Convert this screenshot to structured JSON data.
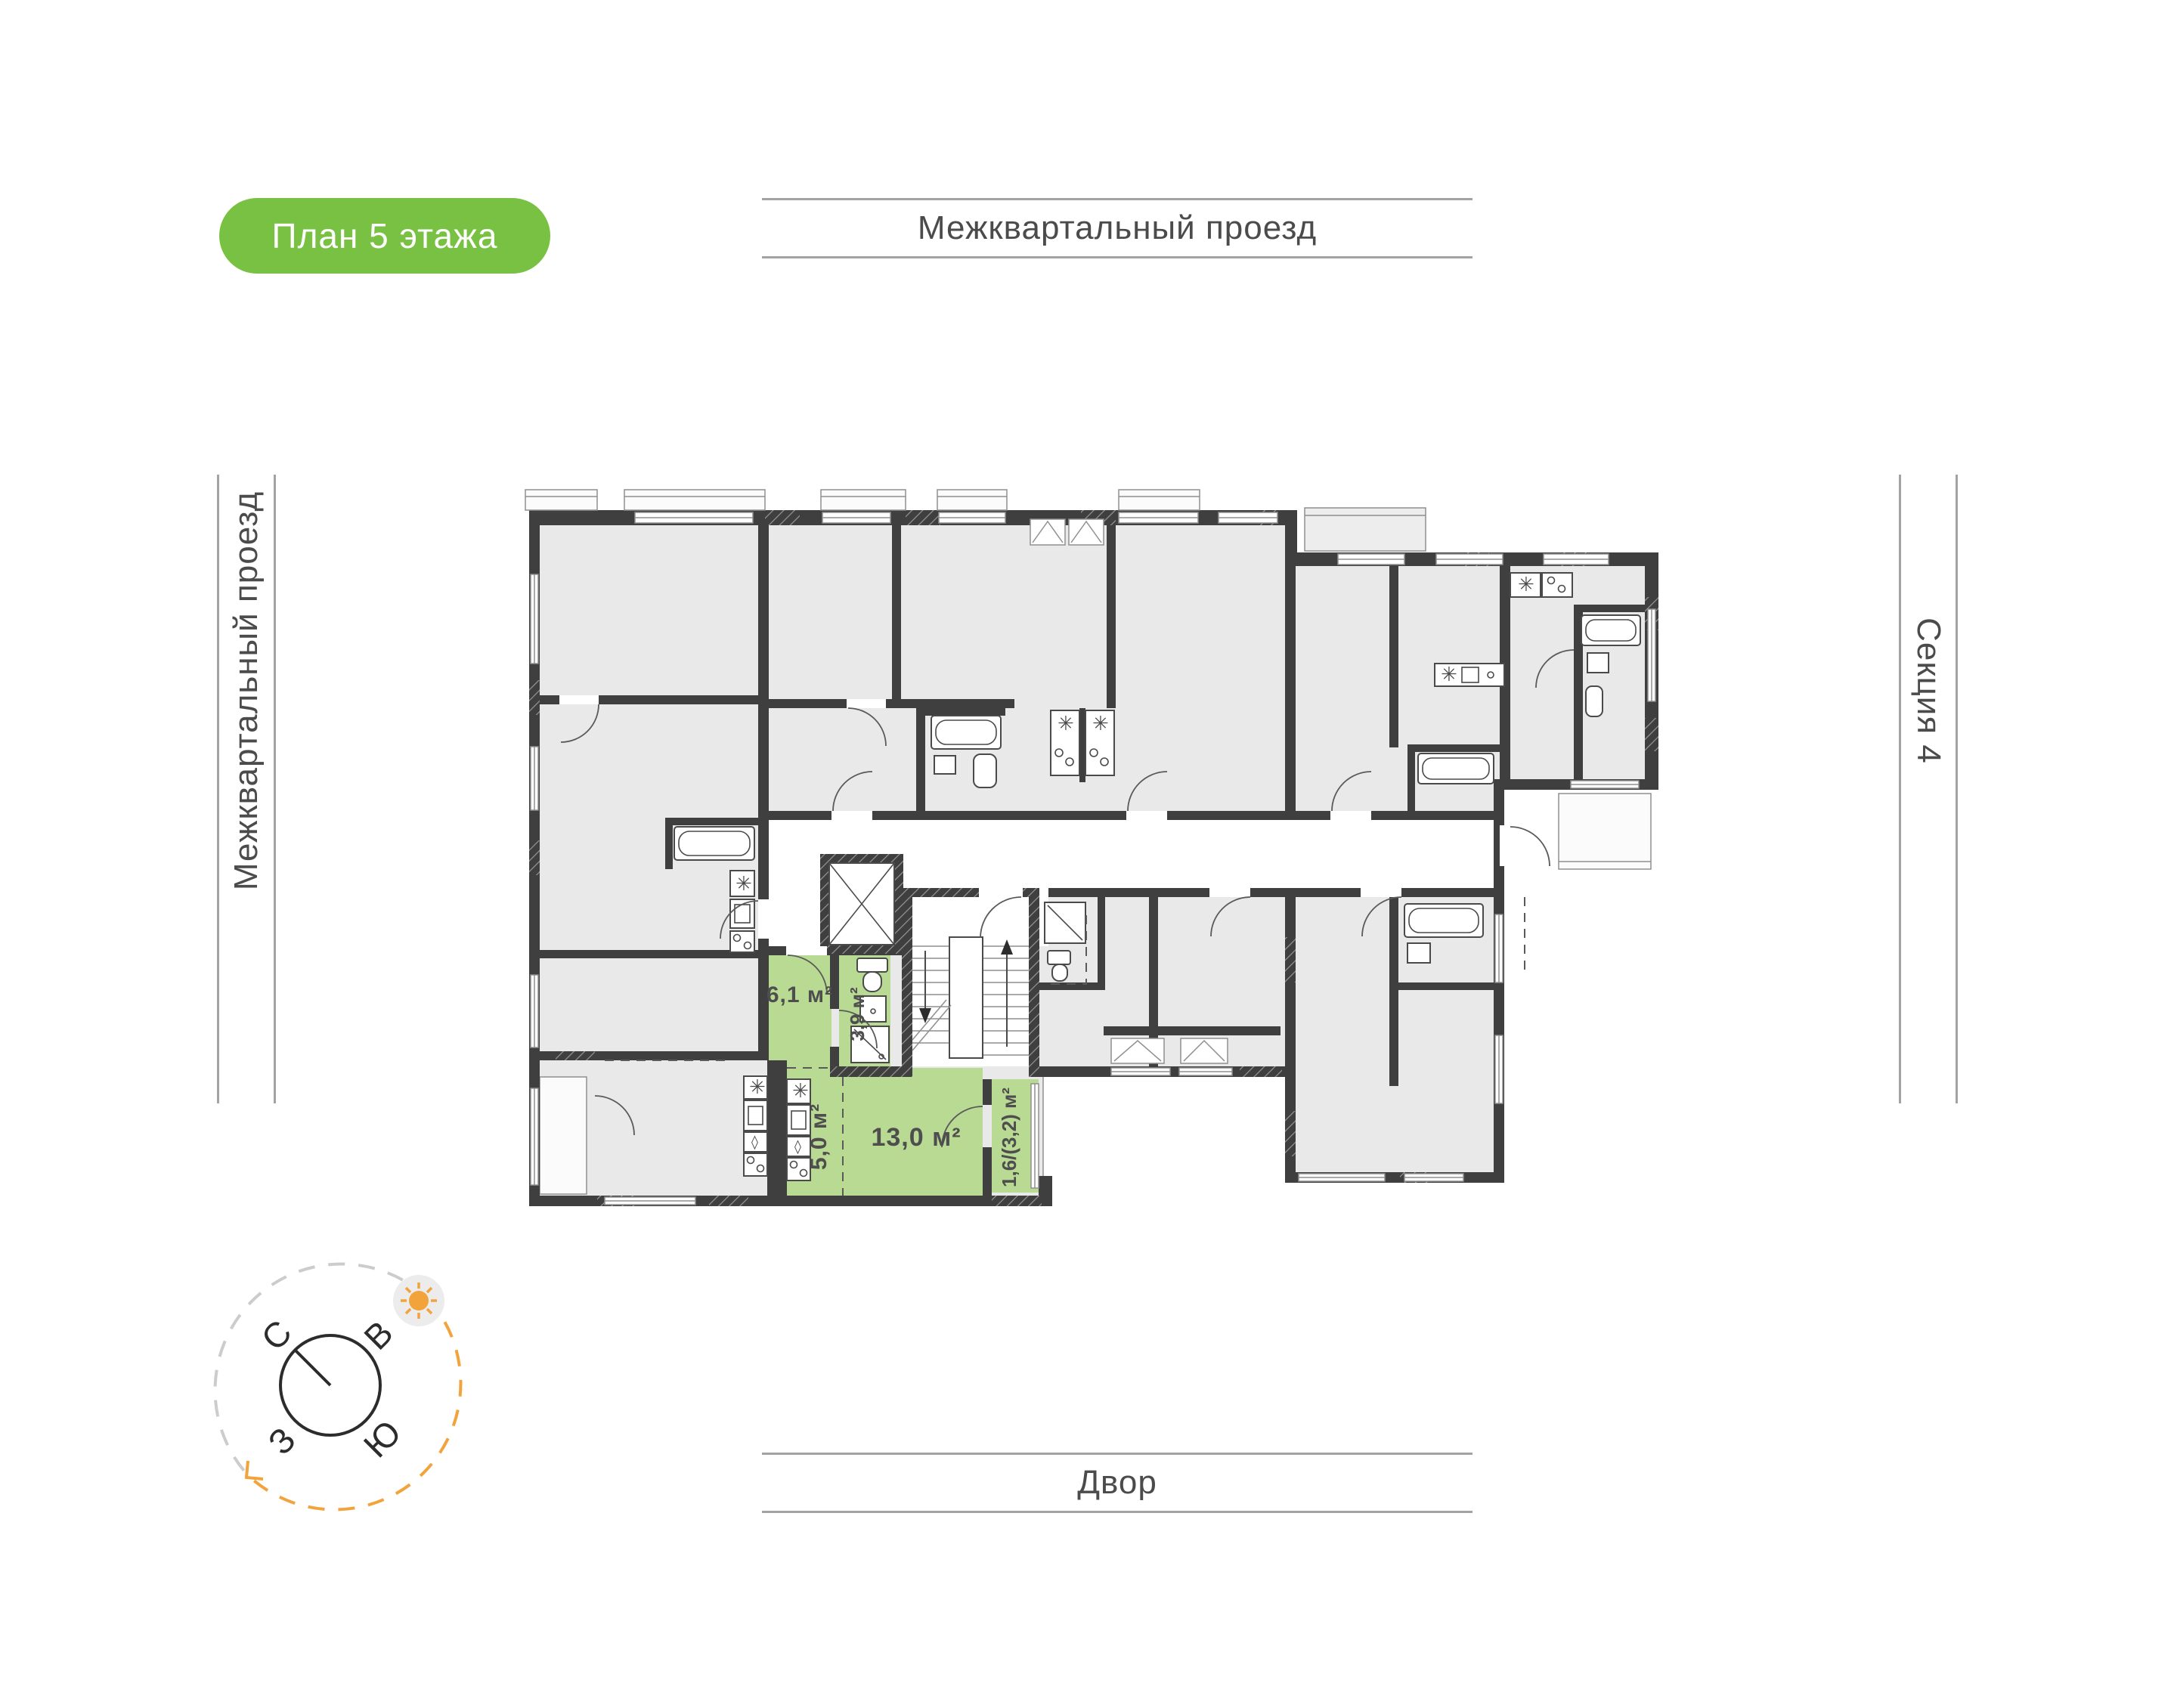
{
  "badge": {
    "label": "План 5 этажа",
    "color": "#79c143"
  },
  "labels": {
    "street_top": "Межквартальный проезд",
    "street_left": "Межквартальный проезд",
    "yard": "Двор",
    "section": "Секция 4"
  },
  "compass": {
    "north": "С",
    "east": "В",
    "south": "Ю",
    "west": "З"
  },
  "apartment": {
    "highlight_color": "#b9da93",
    "rooms": [
      {
        "name": "hallway",
        "area": "6,1 м²"
      },
      {
        "name": "bathroom",
        "area": "3,9 м²"
      },
      {
        "name": "kitchen",
        "area": "5,0 м²"
      },
      {
        "name": "living-room",
        "area": "13,0 м²"
      },
      {
        "name": "balcony",
        "area": "1,6/(3,2) м²"
      }
    ]
  },
  "colors": {
    "wall": "#3f3f3f",
    "room_fill": "#e9e9e9",
    "sun": "#f2a33c"
  }
}
